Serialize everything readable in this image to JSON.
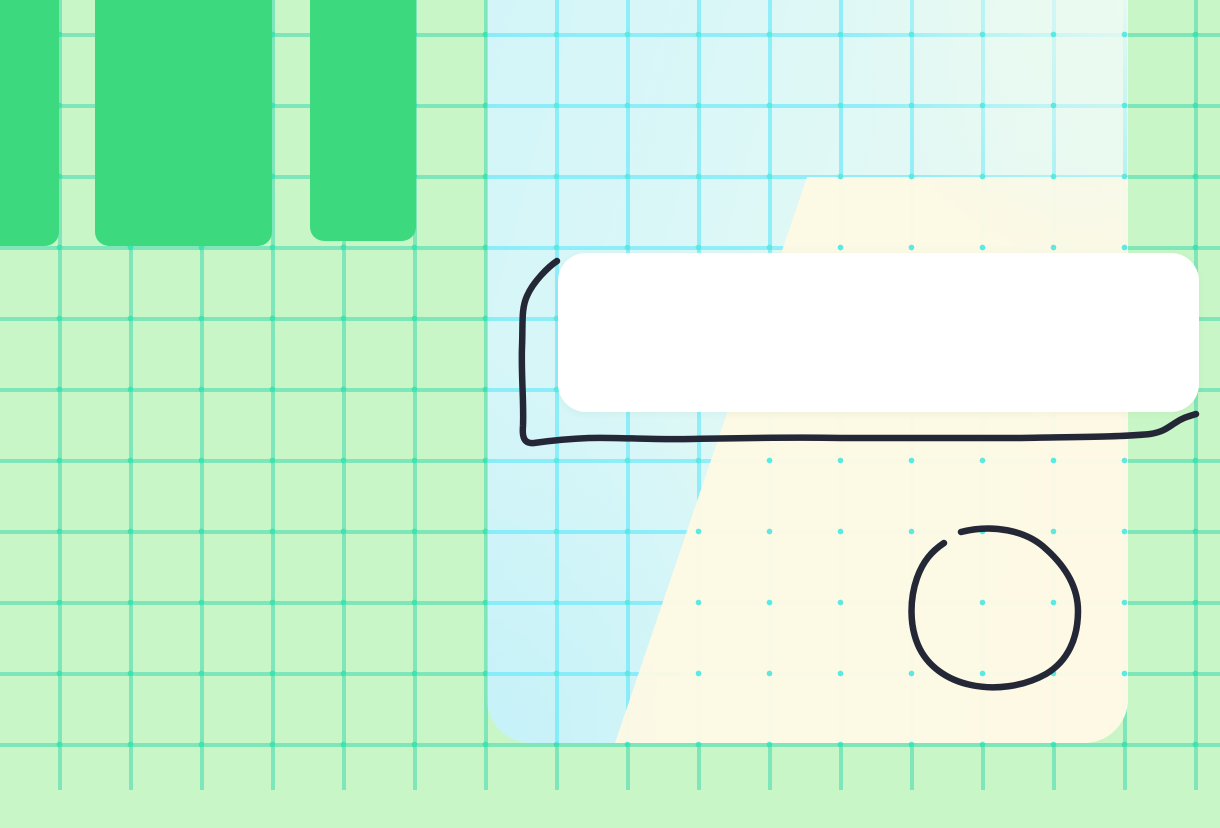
{
  "app": {
    "type": "whiteboard-canvas",
    "visible_text": []
  },
  "colors": {
    "bg": "#c9f6c6",
    "gridline": "#7fe6b9",
    "griddot": "#3fe3ad",
    "column": "#3dd97f",
    "panel-left": "#d2f5f9",
    "panel-top": "#dff8f6",
    "panel-right": "#eefaef",
    "panelgrid": "rgba(80,230,250,0.55)",
    "paneldot": "#5ce9e2",
    "wedge": "rgba(253,249,228,0.96)",
    "wash": "rgba(236,250,240,0.92)",
    "card": "#ffffff",
    "ink": "#242836"
  },
  "canvas": {
    "shapes": {
      "columns": [
        {
          "name": "green-column-1"
        },
        {
          "name": "green-column-2"
        },
        {
          "name": "green-column-3"
        }
      ],
      "panel": {
        "name": "gradient-panel"
      },
      "card": {
        "name": "white-card",
        "text": ""
      },
      "ink": {
        "stroke_shapes": [
          "rectangle-outline",
          "circle-outline"
        ],
        "rect_path": "M 557 261 C 548 267 533 282 527 296 C 521 309 523 324 522 347 C 521 374 524 402 523 426 C 522 437 524 444 534 443 C 548 441 563 439 589 438 C 615 437 651 440 691 439 C 741 438 791 437 841 438 C 901 438 961 438 1021 438 C 1071 437 1122 437 1150 434 C 1163 432 1167 428 1175 423 C 1184 417 1190 416 1196 414",
        "circle_path": "M 961 532 C 992 524 1026 530 1046 549 C 1066 567 1078 587 1078 611 C 1078 638 1068 661 1046 674 C 1023 687 994 690 971 685 C 947 680 927 666 918 645 C 909 624 910 598 917 578 C 923 561 932 551 944 543"
      }
    }
  }
}
